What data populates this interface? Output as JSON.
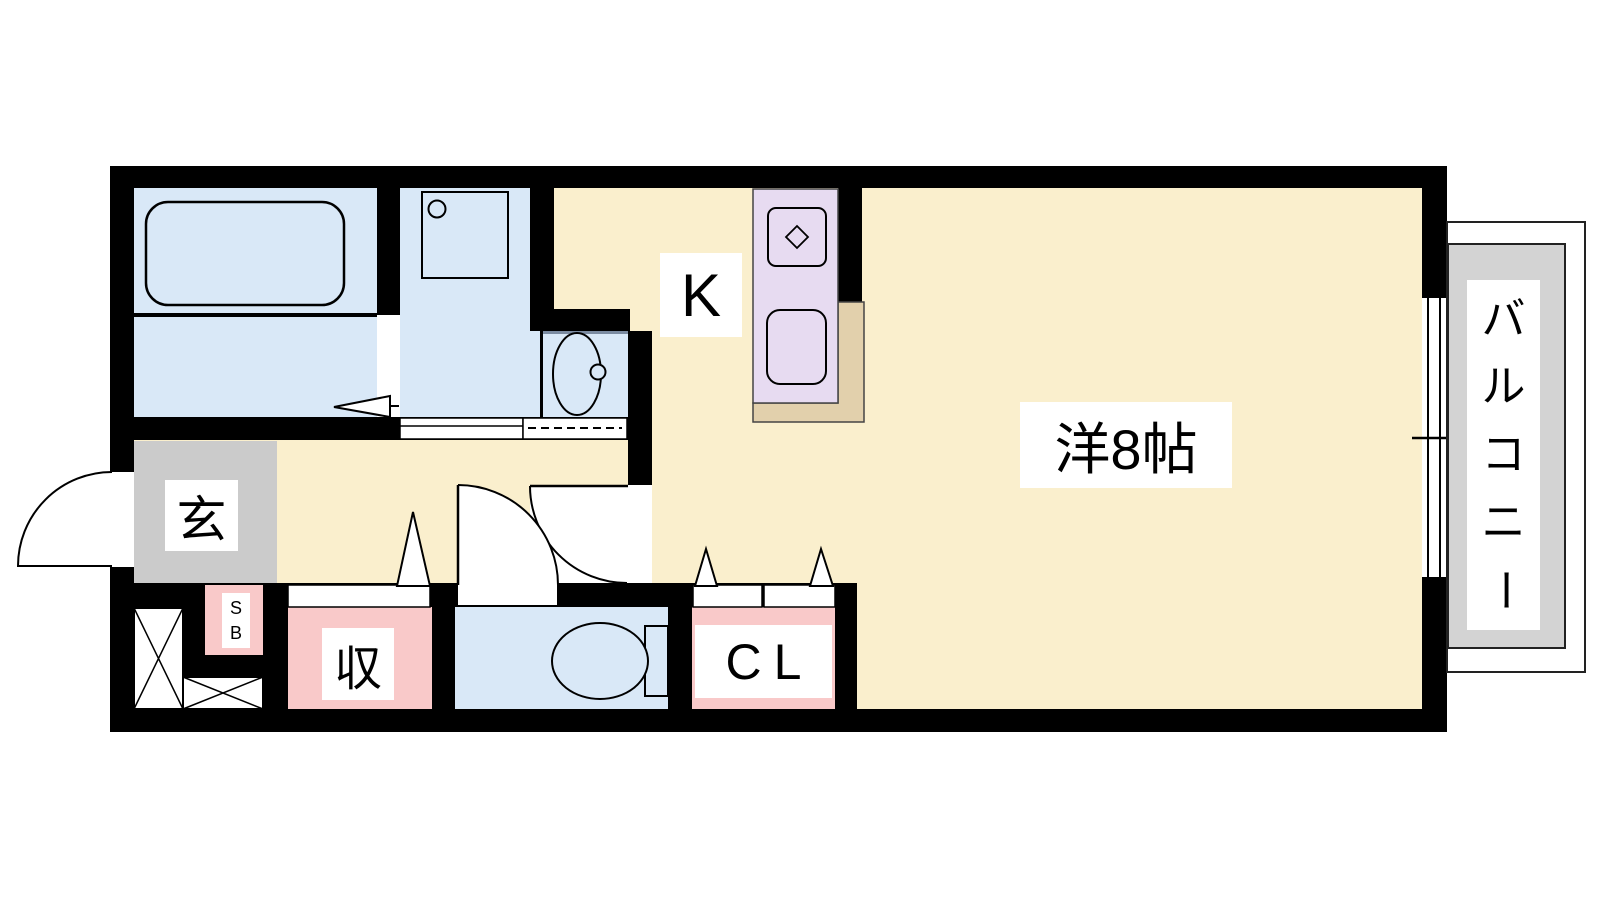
{
  "colors": {
    "wall": "#000000",
    "floor_cream": "#FAEFCD",
    "wet_blue": "#D9E8F7",
    "kitchen_purple": "#E7DBF1",
    "counter_tan": "#E2D0AC",
    "closet_pink": "#F9C9C9",
    "entrance_gray": "#CBCBCB",
    "balcony_gray": "#D3D3D3"
  },
  "rooms": {
    "western_room": {
      "label": "洋8帖"
    },
    "kitchen": {
      "label": "K"
    },
    "balcony": {
      "label": "バルコニー",
      "chars": [
        "バ",
        "ル",
        "コ",
        "ニ",
        "ー"
      ]
    },
    "entrance": {
      "label": "玄"
    },
    "shoe_box": {
      "line1": "S",
      "line2": "B"
    },
    "storage": {
      "label": "収"
    },
    "closet": {
      "label": "CL"
    }
  }
}
